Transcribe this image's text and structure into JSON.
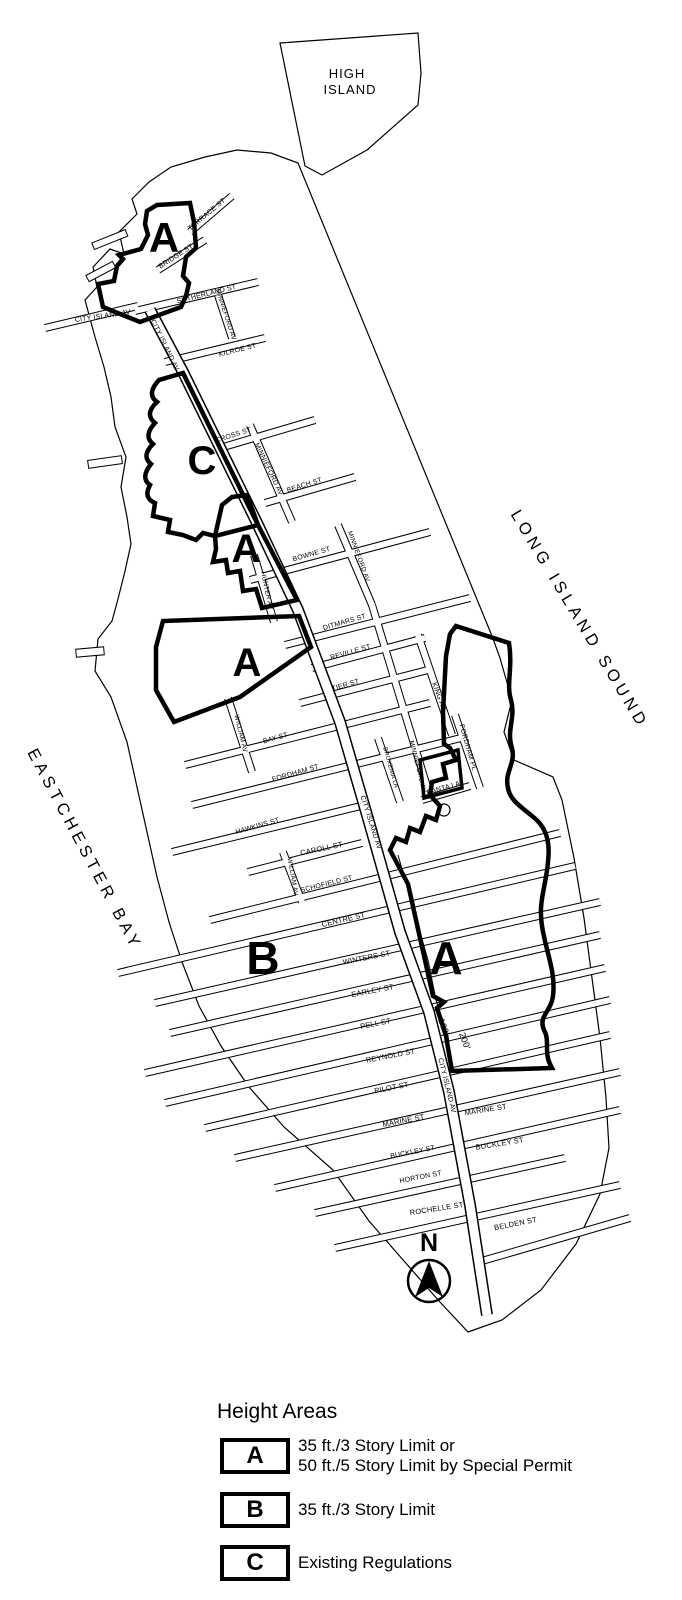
{
  "water": {
    "long_island_sound": "LONG ISLAND SOUND",
    "eastchester_bay": "EASTCHESTER BAY"
  },
  "islands": {
    "high_island_line1": "HIGH",
    "high_island_line2": "ISLAND"
  },
  "streets": [
    "CITY ISLAND AV",
    "CITY ISLAND AV",
    "TERRACE ST",
    "BRIDGE ST",
    "SUTHERLAND ST",
    "MINNIEFORD AV",
    "KILROE ST",
    "CROSS ST",
    "MINNIEFORD AV",
    "BEACH ST",
    "BOWNE ST",
    "MINNIEFORD AV",
    "HUNTER AV",
    "DITMARS ST",
    "REVILLE ST",
    "TIER ST",
    "KING AV",
    "WILLIAM AV",
    "BAY ST",
    "FORDHAM PL",
    "FORDHAM ST",
    "BROXENIA LA",
    "MINNIEFORD AV",
    "BANTA LA",
    "CITY ISLAND AV",
    "HAWKINS ST",
    "CAROLL ST",
    "WILLIAM AV",
    "SCHOFIELD ST",
    "CENTRE ST",
    "WINTERS ST",
    "EARLEY ST",
    "PELL ST",
    "REYNOLD ST",
    "PILOT ST",
    "CITY ISLAND AV",
    "MARINE ST",
    "MARINE ST",
    "BUCKLEY ST",
    "BUCKLEY ST",
    "HORTON ST",
    "ROCHELLE ST",
    "BELDEN ST"
  ],
  "zones": {
    "a_north": "A",
    "c_mid": "C",
    "a_mid": "A",
    "a_rect": "A",
    "b_large": "B",
    "a_east": "A"
  },
  "scale": {
    "d100": "100'",
    "d200": "200'"
  },
  "compass": {
    "n": "N"
  },
  "legend": {
    "title": "Height Areas",
    "items": [
      {
        "key": "A",
        "line1": "35 ft./3 Story Limit or",
        "line2": "50 ft./5 Story Limit by Special Permit"
      },
      {
        "key": "B",
        "line1": "35 ft./3 Story Limit"
      },
      {
        "key": "C",
        "line1": "Existing Regulations"
      }
    ]
  }
}
